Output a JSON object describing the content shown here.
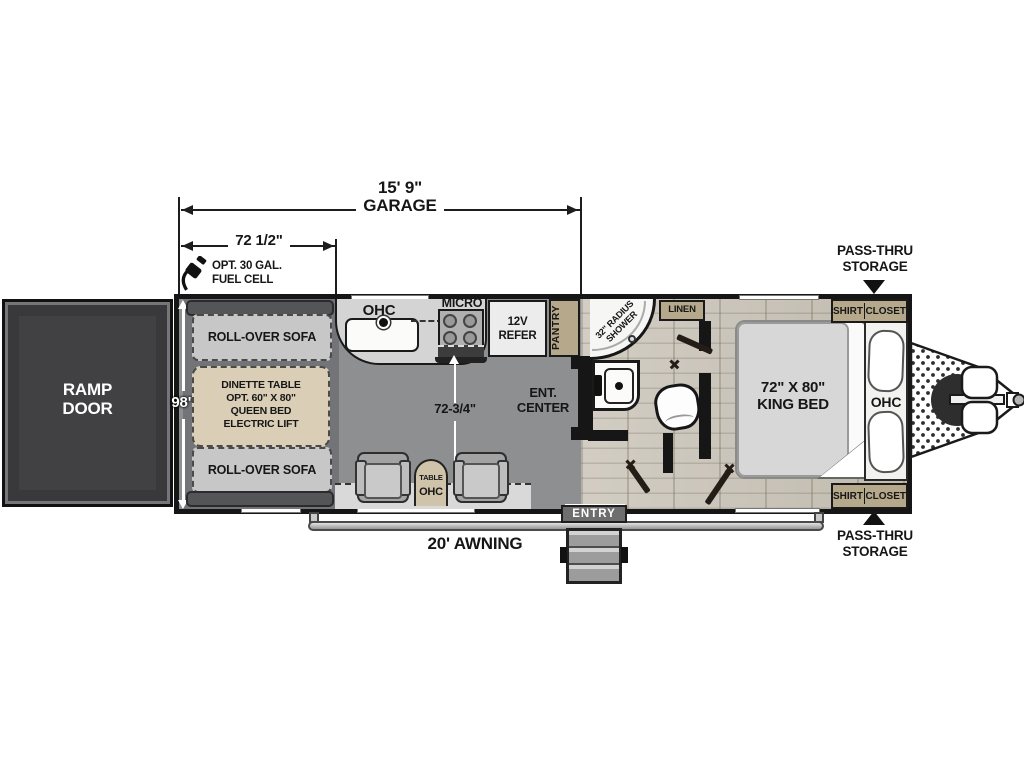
{
  "title": "Toy hauler travel trailer floor plan",
  "colors": {
    "wall": "#161616",
    "garage_floor": "#8e8f91",
    "wood_floor": "#cbc5b9",
    "cabinet_tan": "#b5a88b",
    "ramp_door": "#414144",
    "entry_gray": "#6e6e6e"
  },
  "dims": {
    "garage": {
      "value": "15' 9\"",
      "label": "GARAGE"
    },
    "front_section": "72 1/2\"",
    "body_width": "98\"",
    "interior_width": "72-3/4\"",
    "awning": "20' AWNING"
  },
  "exterior": {
    "ramp_door": [
      "RAMP",
      "DOOR"
    ],
    "fuel_cell": [
      "OPT. 30 GAL.",
      "FUEL CELL"
    ],
    "passthru_front": [
      "PASS-THRU",
      "STORAGE"
    ],
    "passthru_rear": [
      "PASS-THRU",
      "STORAGE"
    ],
    "entry": "ENTRY"
  },
  "garage": {
    "sofa_front": "ROLL-OVER SOFA",
    "sofa_rear": "ROLL-OVER SOFA",
    "dinette": [
      "DINETTE TABLE",
      "OPT. 60\" X 80\"",
      "QUEEN BED",
      "ELECTRIC LIFT"
    ],
    "table": "TABLE",
    "table_ohc": "OHC"
  },
  "kitchen": {
    "ohc": "OHC",
    "micro": "MICRO",
    "refer": [
      "12V",
      "REFER"
    ],
    "pantry": "PANTRY",
    "ent_center": [
      "ENT.",
      "CENTER"
    ]
  },
  "bath": {
    "shower": [
      "32\" RADIUS",
      "SHOWER"
    ],
    "linen": "LINEN"
  },
  "bedroom": {
    "bed": [
      "72\" X 80\"",
      "KING BED"
    ],
    "ohc": "OHC",
    "shirt_closet": [
      "SHIRT",
      "CLOSET"
    ]
  }
}
